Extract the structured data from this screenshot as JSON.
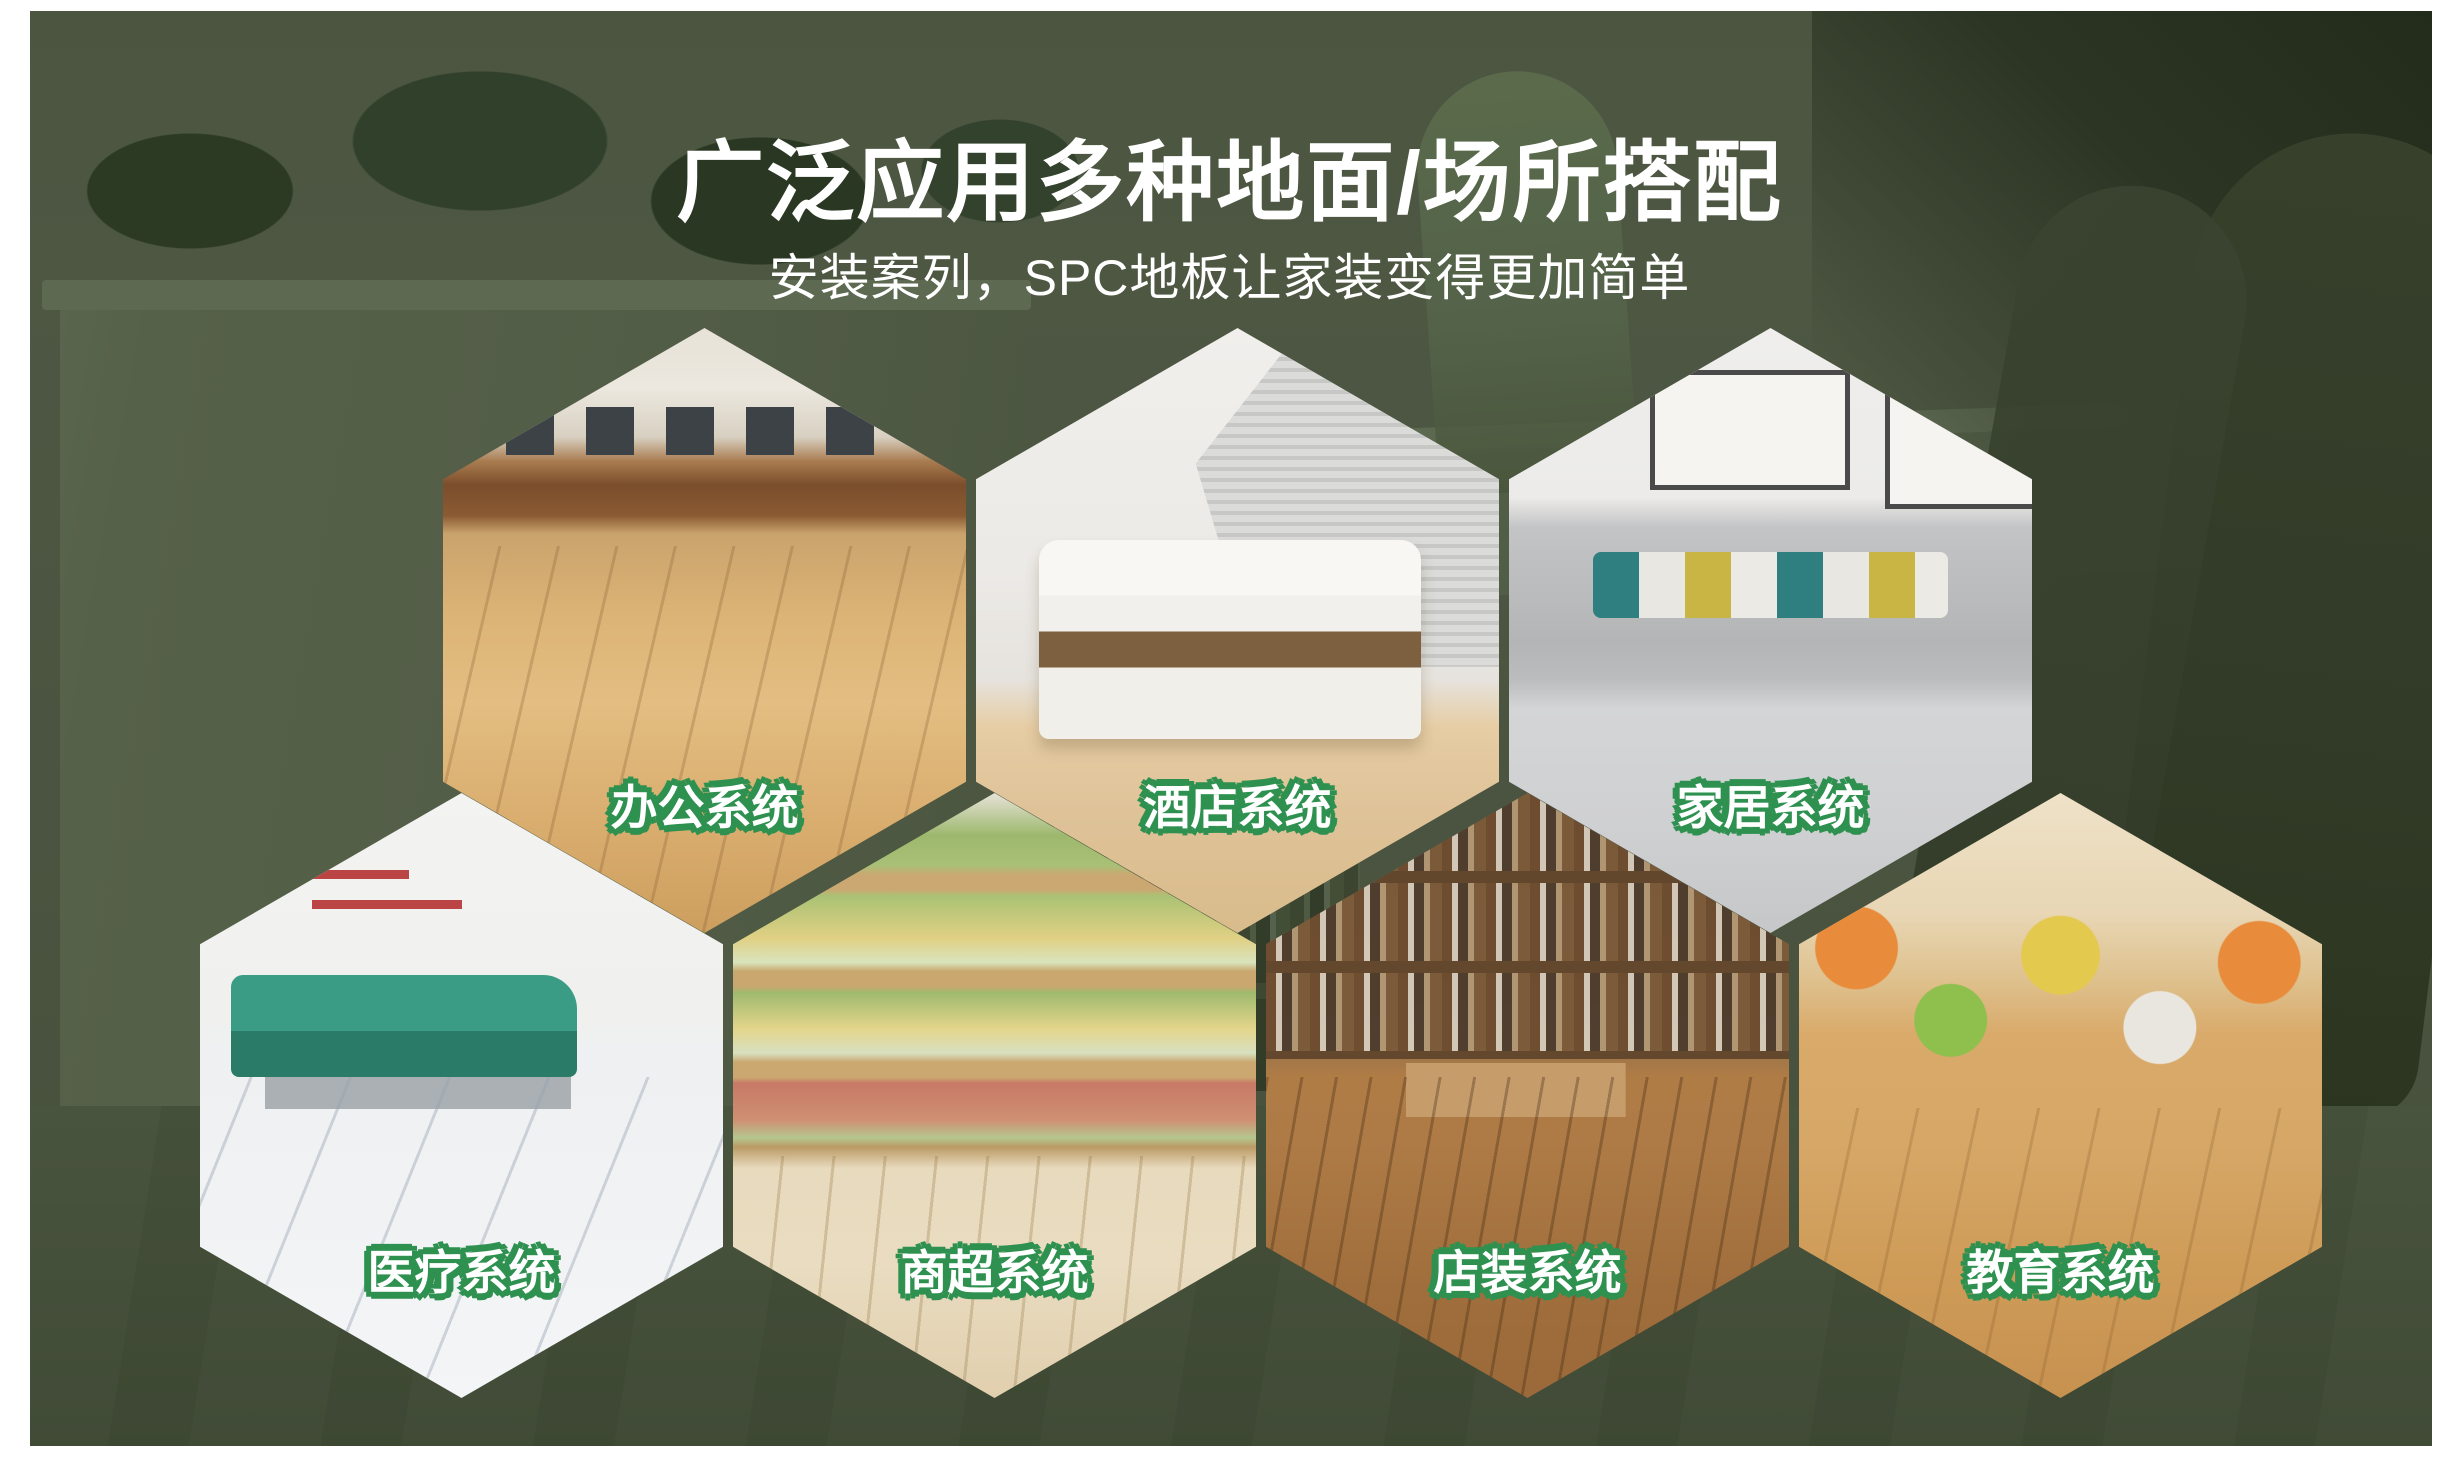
{
  "page": {
    "title": "广泛应用多种地面/场所搭配",
    "subtitle": "安装案列，SPC地板让家装变得更加简单"
  },
  "colors": {
    "label_text": "#FFFFFF",
    "label_outline_green": "#2E9150",
    "headline_text": "#FFFFFF",
    "background_overlay_green": "#4A5440",
    "page_border": "#FFFFFF"
  },
  "hexagons": [
    {
      "id": "office",
      "label": "办公系统",
      "scene": "open-office-with-imac-workstations-on-light-wood-floor",
      "row": "top"
    },
    {
      "id": "hotel",
      "label": "酒店系统",
      "scene": "hotel-bedroom-white-bed-brown-runner-wood-floor",
      "row": "top"
    },
    {
      "id": "home",
      "label": "家居系统",
      "scene": "living-room-grey-sofa-teal-yellow-pillows-grey-floor",
      "row": "top"
    },
    {
      "id": "medical",
      "label": "医疗系统",
      "scene": "clinic-waiting-area-teal-bench-marble-floor",
      "row": "bottom"
    },
    {
      "id": "supermarket",
      "label": "商超系统",
      "scene": "grocery-produce-shelves-pale-wood-floor",
      "row": "bottom"
    },
    {
      "id": "shop",
      "label": "店装系统",
      "scene": "shop-bookshelves-table-parquet-wood-floor",
      "row": "bottom"
    },
    {
      "id": "education",
      "label": "教育系统",
      "scene": "kids-classroom-colorful-stools-wood-floor",
      "row": "bottom"
    }
  ]
}
